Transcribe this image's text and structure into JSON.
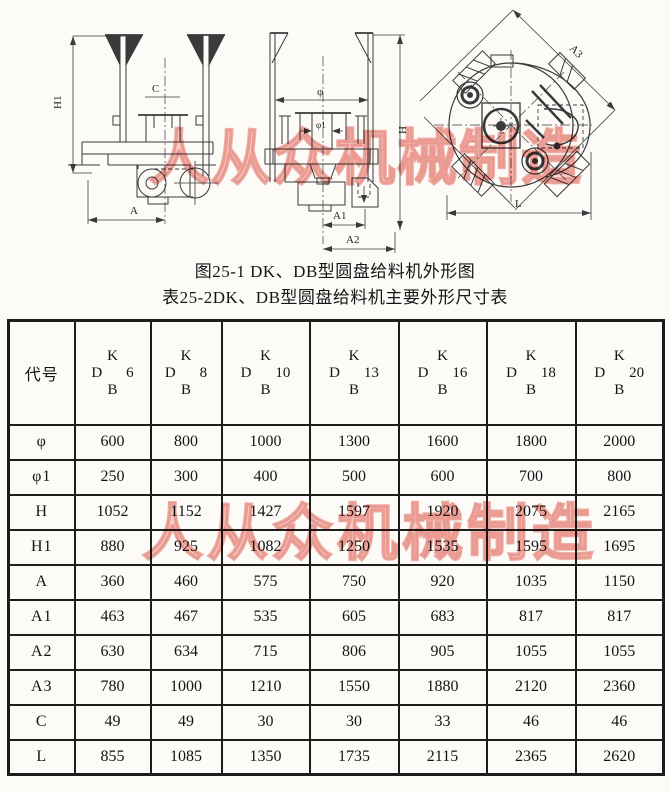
{
  "watermark": {
    "text": "人从众机械制造",
    "color": "#dd5a4e"
  },
  "captions": {
    "figure": "图25-1 DK、DB型圆盘给料机外形图",
    "table": "表25-2DK、DB型圆盘给料机主要外形尺寸表"
  },
  "drawings": {
    "front": {
      "h1": "H1",
      "c": "C",
      "a": "A"
    },
    "section": {
      "phi": "φ",
      "phi1": "φ1",
      "a1": "A1",
      "a2": "A2",
      "h": "H"
    },
    "top": {
      "a3": "A3",
      "l": "L"
    }
  },
  "table": {
    "corner_label": "代号",
    "models": [
      {
        "top": "K",
        "series": "D",
        "num": "6",
        "bottom": "B"
      },
      {
        "top": "K",
        "series": "D",
        "num": "8",
        "bottom": "B"
      },
      {
        "top": "K",
        "series": "D",
        "num": "10",
        "bottom": "B"
      },
      {
        "top": "K",
        "series": "D",
        "num": "13",
        "bottom": "B"
      },
      {
        "top": "K",
        "series": "D",
        "num": "16",
        "bottom": "B"
      },
      {
        "top": "K",
        "series": "D",
        "num": "18",
        "bottom": "B"
      },
      {
        "top": "K",
        "series": "D",
        "num": "20",
        "bottom": "B"
      }
    ],
    "rows": [
      {
        "label": "φ",
        "values": [
          "600",
          "800",
          "1000",
          "1300",
          "1600",
          "1800",
          "2000"
        ]
      },
      {
        "label": "φ1",
        "values": [
          "250",
          "300",
          "400",
          "500",
          "600",
          "700",
          "800"
        ]
      },
      {
        "label": "H",
        "values": [
          "1052",
          "1152",
          "1427",
          "1597",
          "1920",
          "2075",
          "2165"
        ]
      },
      {
        "label": "H1",
        "values": [
          "880",
          "925",
          "1082",
          "1250",
          "1535",
          "1595",
          "1695"
        ]
      },
      {
        "label": "A",
        "values": [
          "360",
          "460",
          "575",
          "750",
          "920",
          "1035",
          "1150"
        ]
      },
      {
        "label": "A1",
        "values": [
          "463",
          "467",
          "535",
          "605",
          "683",
          "817",
          "817"
        ]
      },
      {
        "label": "A2",
        "values": [
          "630",
          "634",
          "715",
          "806",
          "905",
          "1055",
          "1055"
        ]
      },
      {
        "label": "A3",
        "values": [
          "780",
          "1000",
          "1210",
          "1550",
          "1880",
          "2120",
          "2360"
        ]
      },
      {
        "label": "C",
        "values": [
          "49",
          "49",
          "30",
          "30",
          "33",
          "46",
          "46"
        ]
      },
      {
        "label": "L",
        "values": [
          "855",
          "1085",
          "1350",
          "1735",
          "2115",
          "2365",
          "2620"
        ]
      }
    ]
  }
}
